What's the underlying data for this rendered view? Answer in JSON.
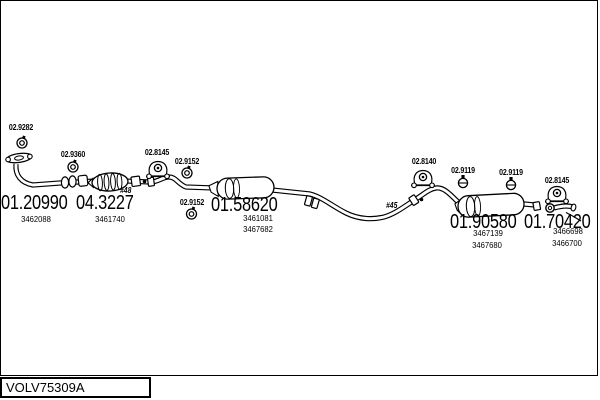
{
  "colors": {
    "ink": "#000000",
    "background": "#ffffff"
  },
  "hardware": [
    {
      "label": "02.9282"
    },
    {
      "label": "02.9360"
    },
    {
      "label": "02.8145"
    },
    {
      "label": "02.9152"
    },
    {
      "label": "02.9152"
    },
    {
      "label": "02.8140"
    },
    {
      "label": "02.9119"
    },
    {
      "label": "02.9119"
    },
    {
      "label": "02.8145"
    }
  ],
  "parts": [
    {
      "number": "01.20990",
      "oe": [
        "3462088"
      ]
    },
    {
      "number": "04.3227",
      "oe": [
        "3461740"
      ]
    },
    {
      "number": "01.58620",
      "oe": [
        "3461081",
        "3467682"
      ]
    },
    {
      "number": "01.90580",
      "oe": [
        "3467139",
        "3467680"
      ]
    },
    {
      "number": "01.70420",
      "oe": [
        "3466698",
        "3466700"
      ]
    }
  ],
  "markers": {
    "catalytic": "#48",
    "rear_pipe": "#45"
  },
  "footer": {
    "code": "VOLV75309A"
  }
}
